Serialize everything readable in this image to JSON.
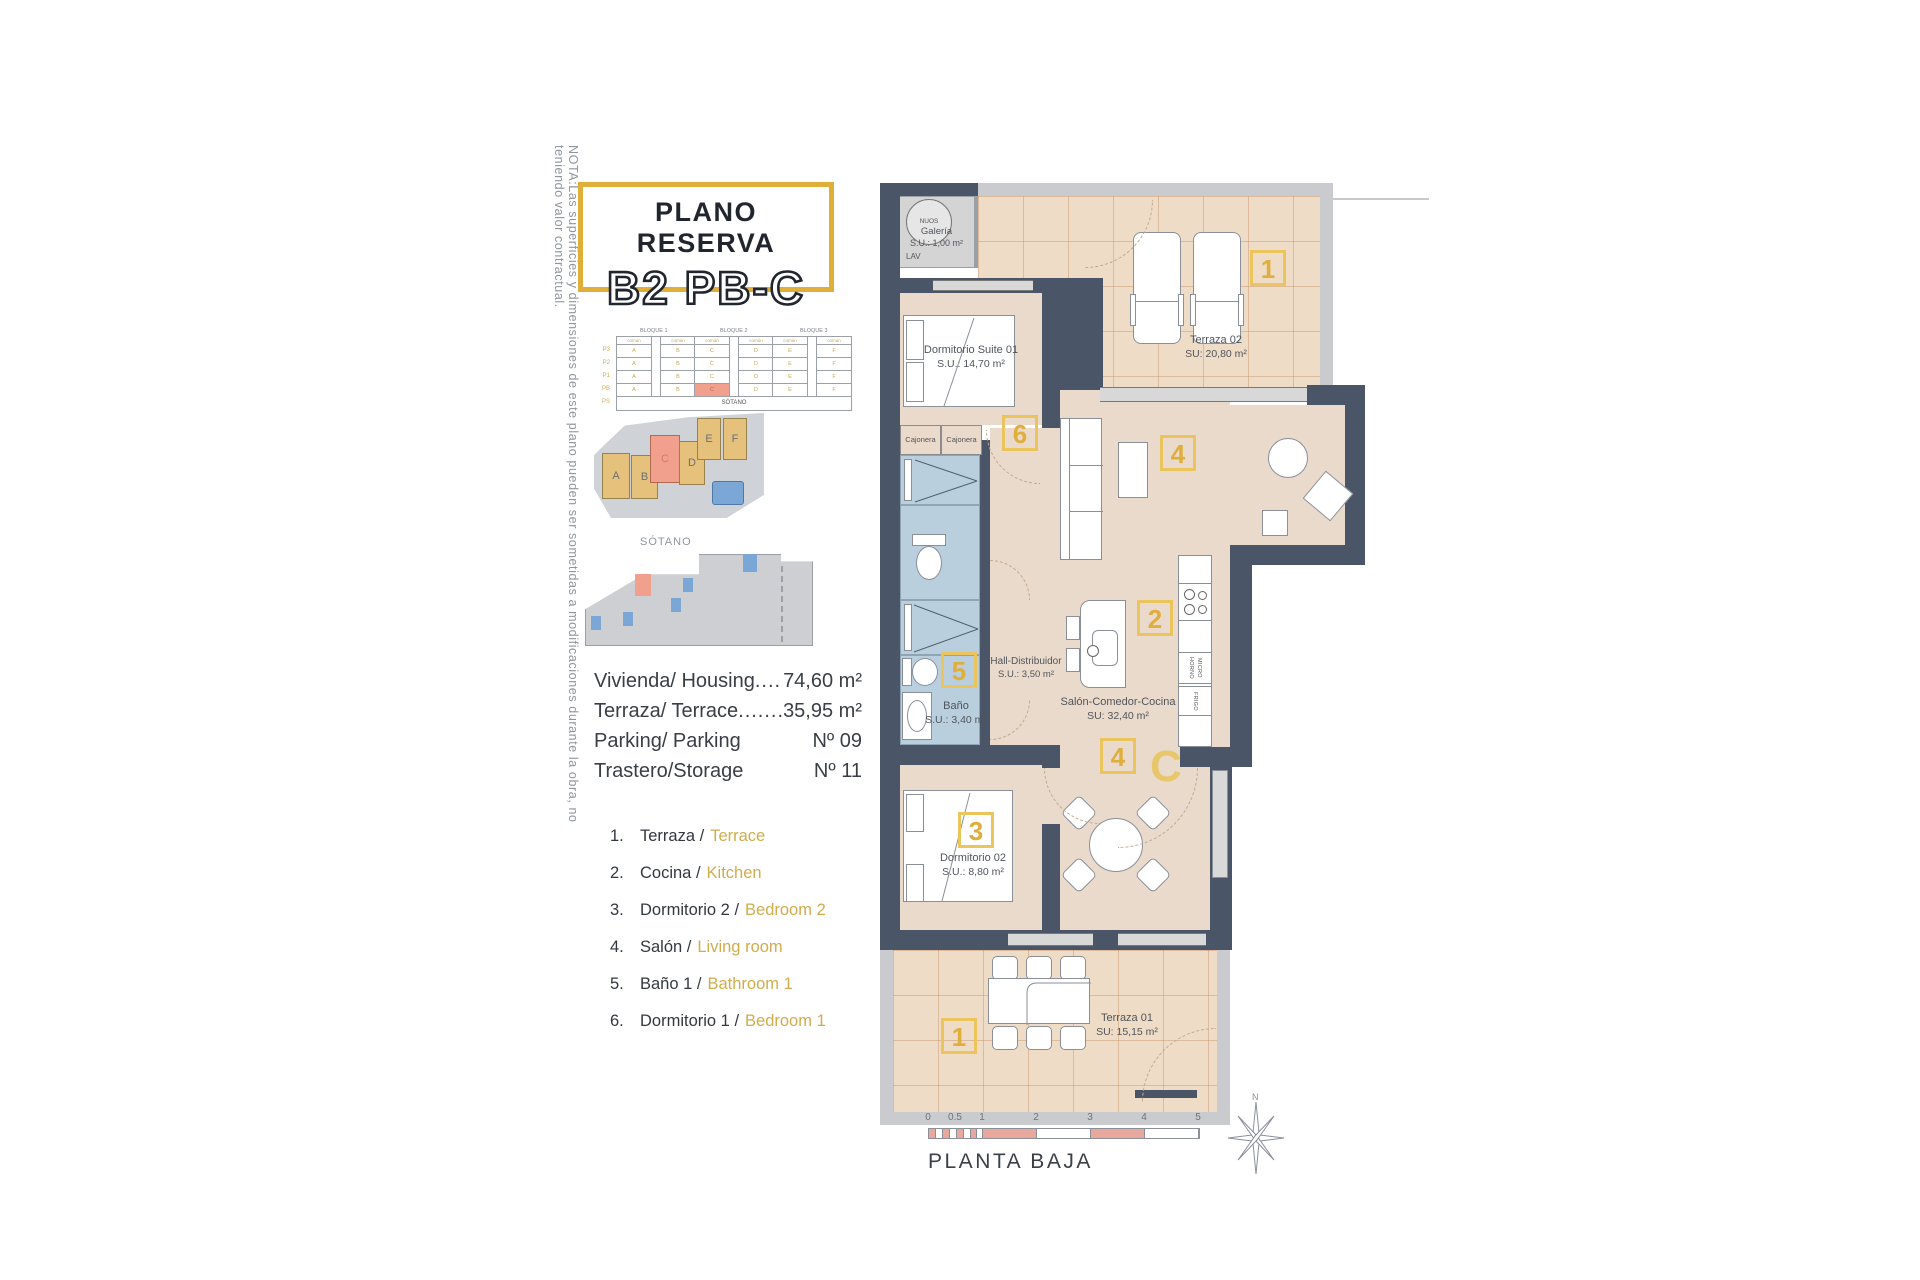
{
  "note": "NOTA:Las superficies y dimensiones de este plano pueden ser sometidas a modificaciones durante la obra, no teniendo valor contractual.",
  "title": {
    "line1": "PLANO RESERVA",
    "line2": "B2 PB-C"
  },
  "block_chart": {
    "bloques": [
      "BLOQUE 1",
      "BLOQUE 2",
      "BLOQUE 3"
    ],
    "floors": [
      "P3",
      "P2",
      "P1",
      "PB",
      "PS"
    ],
    "units": [
      "A",
      "B",
      "C",
      "D",
      "E",
      "F"
    ],
    "subheader": "común",
    "sotano": "SÓTANO"
  },
  "site_plan": {
    "blocks": [
      "A",
      "B",
      "C",
      "D",
      "E",
      "F"
    ]
  },
  "sotano_label": "SÓTANO",
  "summary": {
    "rows": [
      {
        "label": "Vivienda/ Housing",
        "dots": ".......",
        "value": "74,60 m²"
      },
      {
        "label": "Terraza/ Terrace",
        "dots": ".............",
        "value": "35,95 m²"
      },
      {
        "label": "Parking/ Parking",
        "dots": "",
        "value": "Nº 09"
      },
      {
        "label": "Trastero/Storage",
        "dots": "",
        "value": "Nº 11"
      }
    ]
  },
  "legend": [
    {
      "num": "1.",
      "es": "Terraza /",
      "en": "Terrace"
    },
    {
      "num": "2.",
      "es": "Cocina /",
      "en": "Kitchen"
    },
    {
      "num": "3.",
      "es": "Dormitorio 2 /",
      "en": "Bedroom 2"
    },
    {
      "num": "4.",
      "es": "Salón /",
      "en": "Living room"
    },
    {
      "num": "5.",
      "es": "Baño 1 /",
      "en": "Bathroom 1"
    },
    {
      "num": "6.",
      "es": "Dormitorio 1 /",
      "en": "Bedroom 1"
    }
  ],
  "plan": {
    "galeria": {
      "equip": "NUOS",
      "name": "Galería",
      "area": "S.U.: 1,00 m²",
      "lav": "LAV"
    },
    "rooms": [
      {
        "name": "Dormitorio Suite 01",
        "area": "S.U.: 14,70 m²"
      },
      {
        "name": "Terraza 02",
        "area": "SU: 20,80 m²"
      },
      {
        "name": "Hall-Distribuidor",
        "area": "S.U.: 3,50 m²"
      },
      {
        "name": "Salón-Comedor-Cocina",
        "area": "SU: 32,40 m²"
      },
      {
        "name": "Baño",
        "area": "S.U.: 3,40 m²"
      },
      {
        "name": "Dormitorio 02",
        "area": "S.U.: 8,80 m²"
      },
      {
        "name": "Terraza 01",
        "area": "SU: 15,15 m²"
      }
    ],
    "badges": [
      "1",
      "6",
      "5",
      "2",
      "4",
      "4",
      "3",
      "1"
    ],
    "cajonera": "Cajonera",
    "kitchen": {
      "horno": "HORNO",
      "micro": "MICRO",
      "frigo": "FRIGO"
    },
    "door_letter": "C"
  },
  "scalebar": {
    "ticks": [
      "0",
      "0.5",
      "1",
      "2",
      "3",
      "4",
      "5"
    ]
  },
  "footer": {
    "plan_name": "PLANTA BAJA",
    "compass": "N"
  }
}
